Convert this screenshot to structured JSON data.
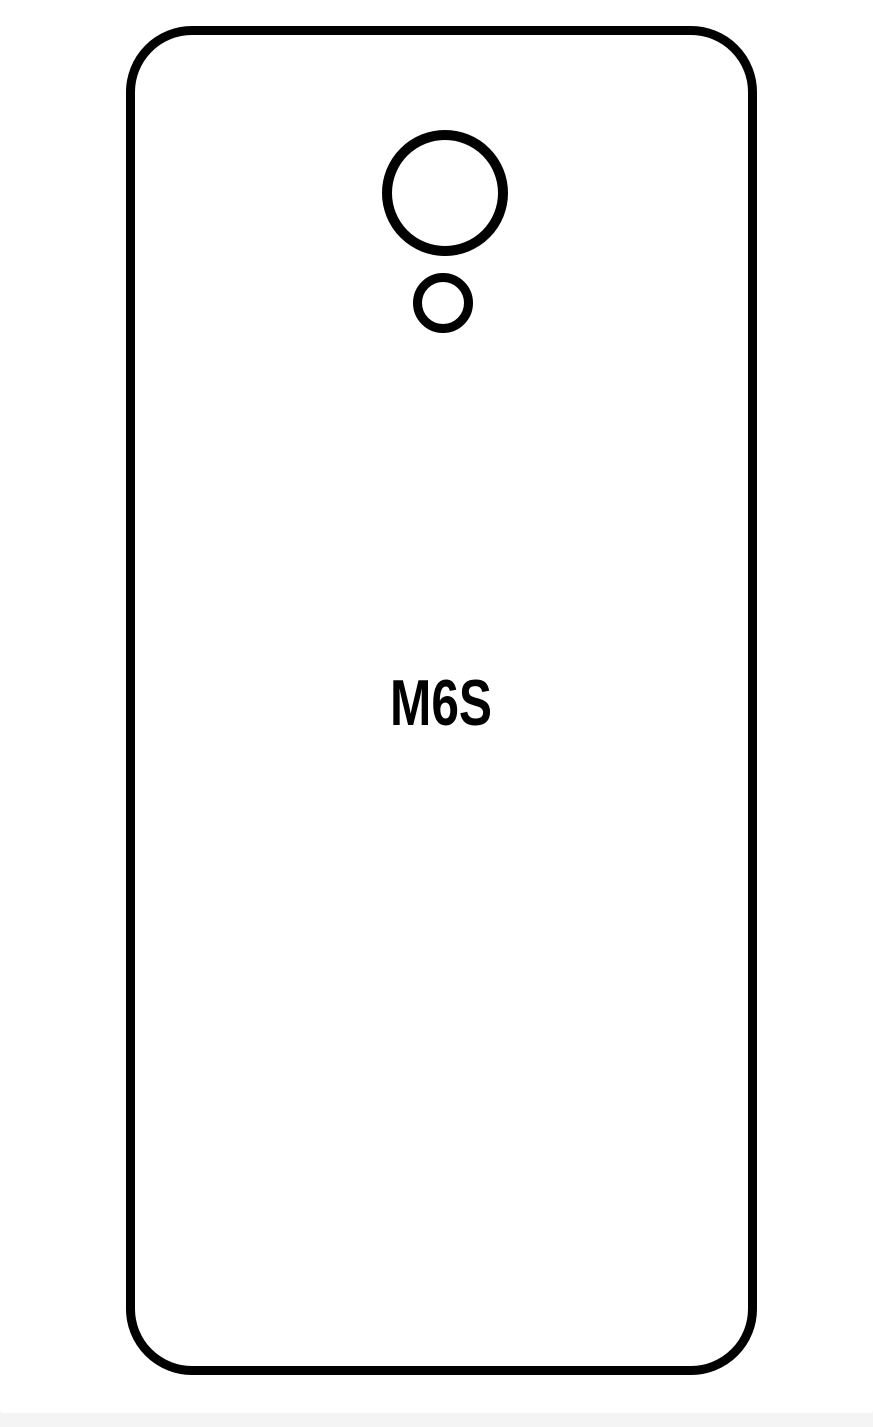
{
  "page": {
    "kind": "screen-protector cutting template / product line drawing"
  },
  "colors": {
    "ink": "#000000",
    "paper": "#ffffff",
    "page_bg": "#f4f4f5"
  },
  "diagram": {
    "model_label": "M6S",
    "shapes": {
      "phone_outline": "rounded-rectangle phone back outline",
      "camera_cutout": "large circle cutout",
      "flash_cutout": "small circle cutout"
    }
  }
}
